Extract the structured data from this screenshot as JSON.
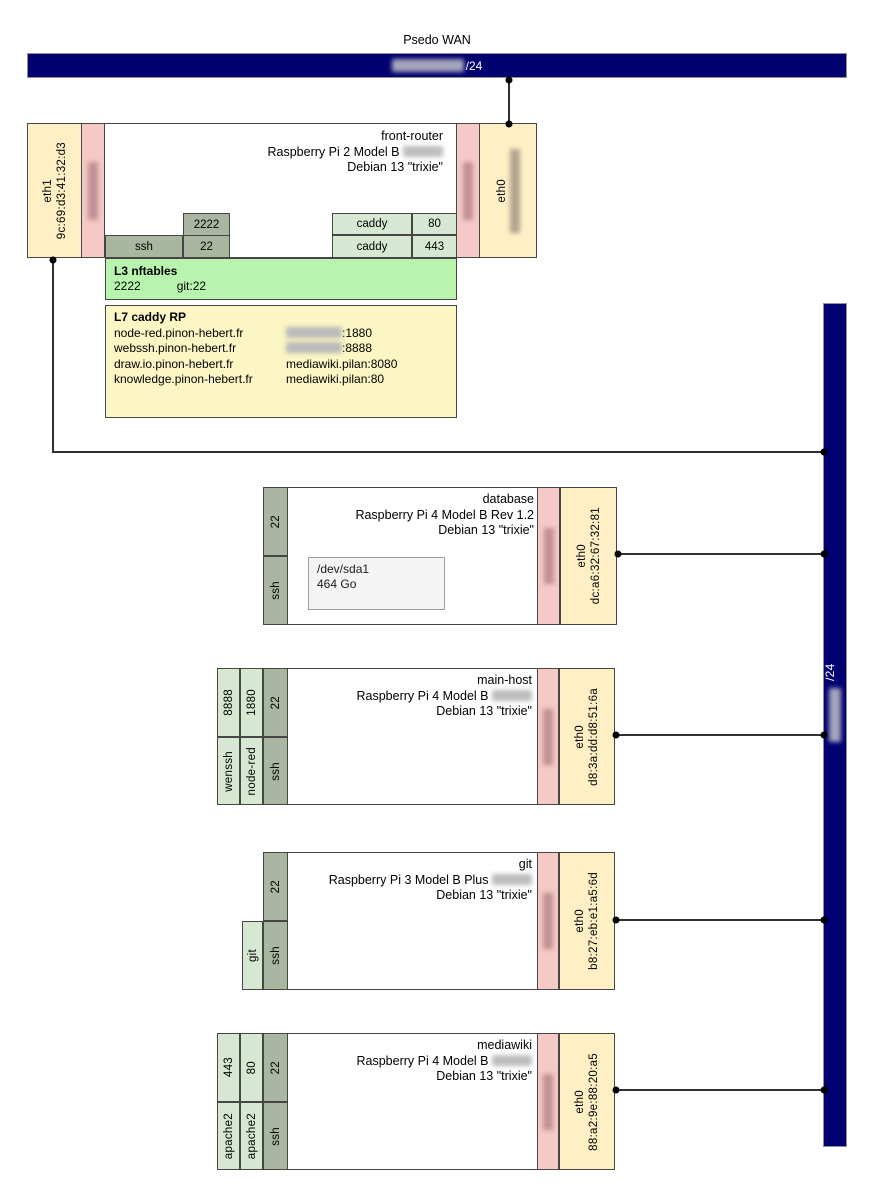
{
  "wan": {
    "title": "Psedo WAN",
    "cidr_suffix": "/24"
  },
  "lan": {
    "cidr_suffix": "/24"
  },
  "front_router": {
    "name": "front-router",
    "model": "Raspberry Pi 2 Model B",
    "os": "Debian 13 \"trixie\"",
    "eth1": {
      "label": "eth1",
      "mac": "9c:69:d3:41:32:d3"
    },
    "eth0": {
      "label": "eth0"
    },
    "nat": {
      "external_port": "2222",
      "service": "ssh",
      "port": "22"
    },
    "caddy_ports": [
      {
        "service": "caddy",
        "port": "80"
      },
      {
        "service": "caddy",
        "port": "443"
      }
    ],
    "nftables": {
      "title": "L3 nftables",
      "from": "2222",
      "to": "git:22"
    },
    "caddy_rp": {
      "title": "L7 caddy RP",
      "rules": [
        {
          "host": "node-red.pinon-hebert.fr",
          "target": ":1880"
        },
        {
          "host": "webssh.pinon-hebert.fr",
          "target": ":8888"
        },
        {
          "host": "draw.io.pinon-hebert.fr",
          "target": "mediawiki.pilan:8080"
        },
        {
          "host": "knowledge.pinon-hebert.fr",
          "target": "mediawiki.pilan:80"
        }
      ]
    }
  },
  "hosts": [
    {
      "name": "database",
      "model": "Raspberry Pi 4 Model B Rev 1.2",
      "os": "Debian 13 \"trixie\"",
      "iface": {
        "label": "eth0",
        "mac": "dc:a6:32:67:32:81"
      },
      "services": [
        {
          "port": "22",
          "name": "ssh"
        }
      ],
      "storage": {
        "device": "/dev/sda1",
        "size": "464 Go"
      }
    },
    {
      "name": "main-host",
      "model": "Raspberry Pi 4 Model B",
      "os": "Debian 13 \"trixie\"",
      "iface": {
        "label": "eth0",
        "mac": "d8:3a:dd:d8:51:6a"
      },
      "services": [
        {
          "port": "8888",
          "name": "wenssh"
        },
        {
          "port": "1880",
          "name": "node-red"
        },
        {
          "port": "22",
          "name": "ssh"
        }
      ]
    },
    {
      "name": "git",
      "model": "Raspberry Pi 3 Model B Plus",
      "os": "Debian 13 \"trixie\"",
      "iface": {
        "label": "eth0",
        "mac": "b8:27:eb:e1:a5:6d"
      },
      "services": [
        {
          "name": "git"
        },
        {
          "port": "22",
          "name": "ssh"
        }
      ]
    },
    {
      "name": "mediawiki",
      "model": "Raspberry Pi 4 Model B",
      "os": "Debian 13 \"trixie\"",
      "iface": {
        "label": "eth0",
        "mac": "88:a2:9e:88:20:a5"
      },
      "services": [
        {
          "port": "443",
          "name": "apache2"
        },
        {
          "port": "80",
          "name": "apache2"
        },
        {
          "port": "22",
          "name": "ssh"
        }
      ]
    }
  ],
  "colors": {
    "backbone": "#000070",
    "interface_fill": "#ffefc5",
    "ip_fill": "#f4c9c6",
    "service_fill": "#d6e8d2",
    "ssh_fill": "#a9b7a1",
    "nftables_fill": "#b9f4af",
    "caddy_rp_fill": "#fbf6c4"
  }
}
